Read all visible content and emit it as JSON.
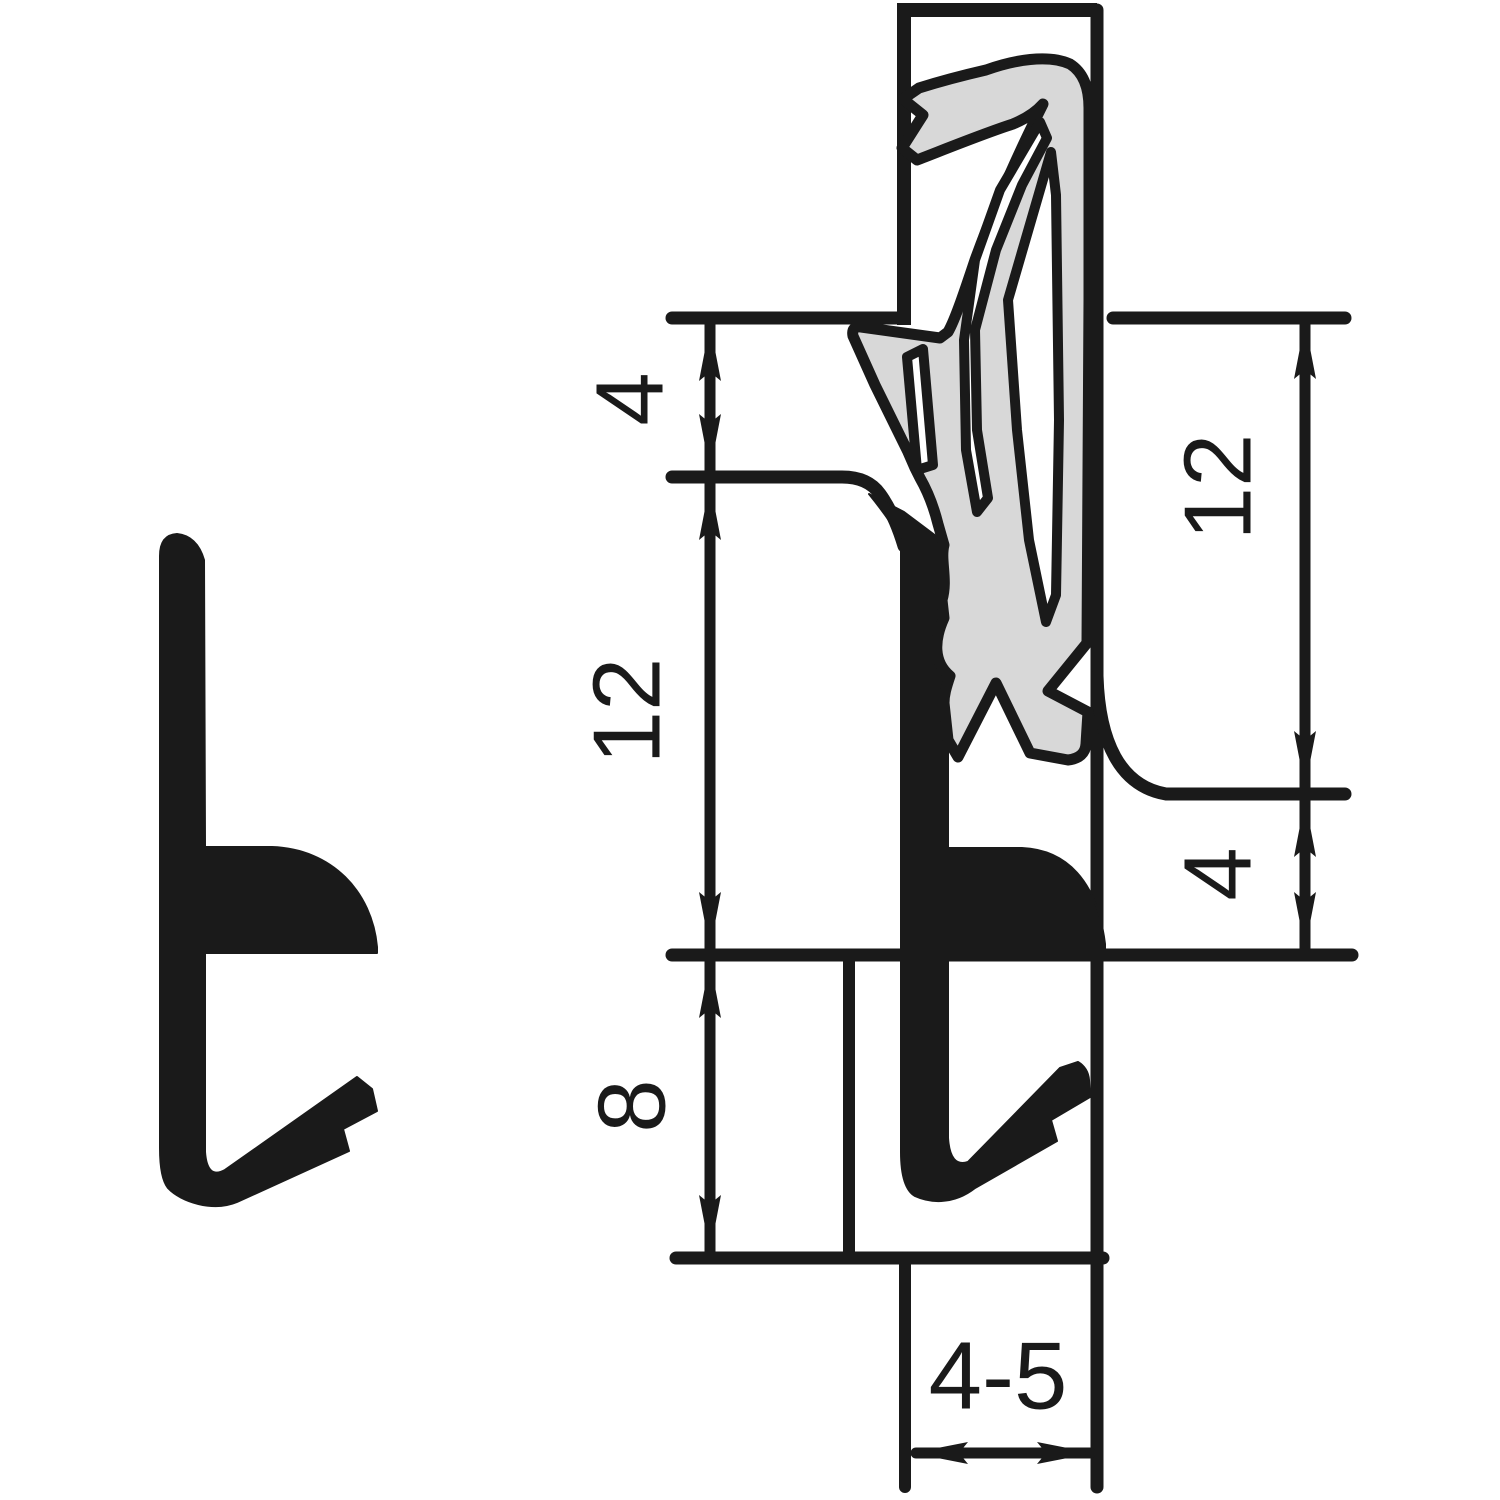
{
  "drawing": {
    "type": "technical-cross-section",
    "background": "#ffffff",
    "ink": "#1a1a1a",
    "seal_fill": "#d8d8d8",
    "dimensions": {
      "left": [
        {
          "label": "4"
        },
        {
          "label": "12"
        },
        {
          "label": "8"
        }
      ],
      "right": [
        {
          "label": "12"
        },
        {
          "label": "4"
        }
      ],
      "bottom": {
        "label": "4-5"
      }
    }
  }
}
